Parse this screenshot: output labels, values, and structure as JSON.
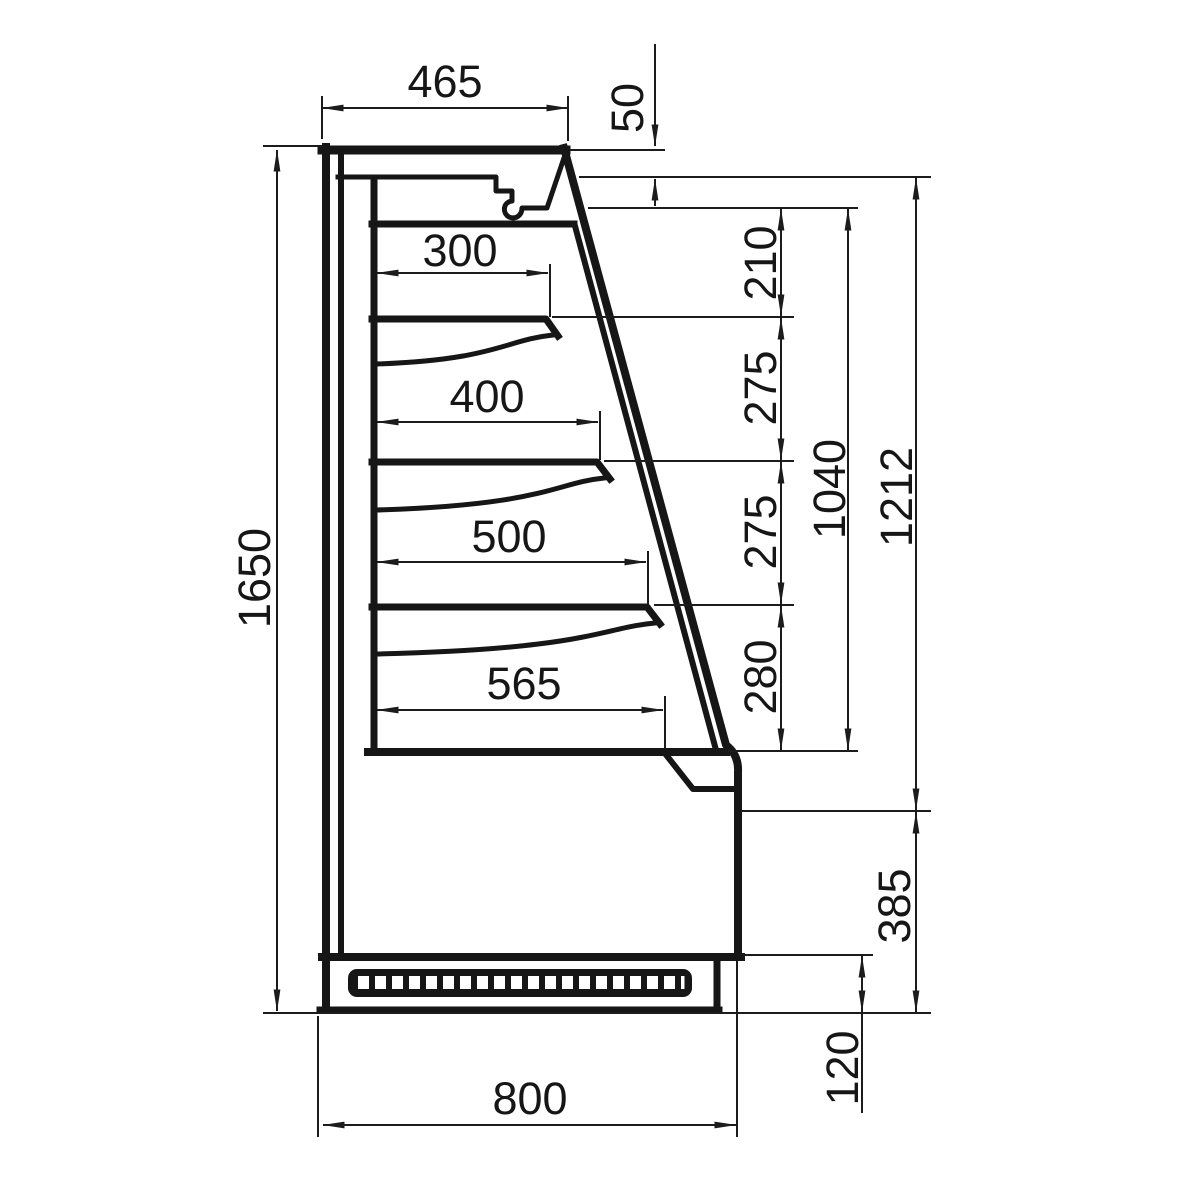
{
  "dimensions": {
    "top_depth": "465",
    "canopy_height": "50",
    "shelf_depths": [
      "300",
      "400",
      "500",
      "565"
    ],
    "shelf_spacings": [
      "210",
      "275",
      "275",
      "280"
    ],
    "opening_height": "1040",
    "front_height": "1212",
    "base_height": "385",
    "plinth_height": "120",
    "total_height": "1650",
    "total_depth": "800"
  }
}
